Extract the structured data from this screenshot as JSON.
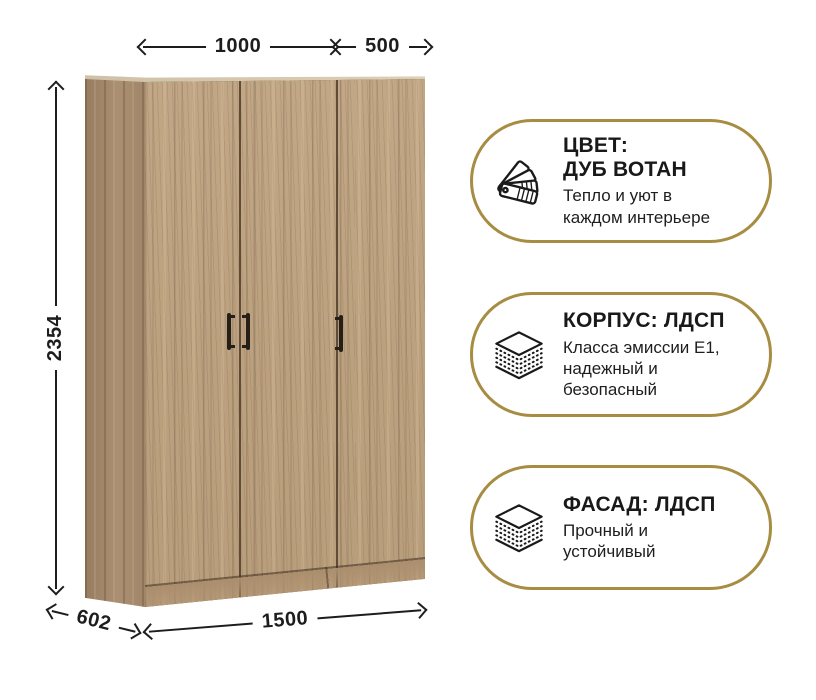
{
  "page": {
    "background": "#ffffff"
  },
  "wardrobe": {
    "description": "three-door wardrobe, oak wotan wood finish, perspective view",
    "door_count": 3,
    "wood_base_color": "#bfa483",
    "wood_dark_streak": "#8f7a60",
    "wood_side_color": "#a4886b",
    "handle_color": "#261f18"
  },
  "dimensions": {
    "top_width_left": "1000",
    "top_width_right": "500",
    "height": "2354",
    "depth": "602",
    "width_total": "1500"
  },
  "cards": [
    {
      "icon": "color-swatches-icon",
      "title_lines": [
        "ЦВЕТ:",
        "ДУБ ВОТАН"
      ],
      "subtitle_lines": [
        "Тепло и уют в",
        "каждом интерьере"
      ]
    },
    {
      "icon": "layers-icon",
      "title_lines": [
        "КОРПУС: ЛДСП"
      ],
      "subtitle_lines": [
        "Класса эмиссии Е1,",
        "надежный и",
        "безопасный"
      ]
    },
    {
      "icon": "layers-icon",
      "title_lines": [
        "ФАСАД: ЛДСП"
      ],
      "subtitle_lines": [
        "Прочный и",
        "устойчивый"
      ]
    }
  ],
  "colors": {
    "accent_gold": "#a78d42",
    "text": "#1c1c1c",
    "icon_stroke": "#1a1a1a"
  }
}
